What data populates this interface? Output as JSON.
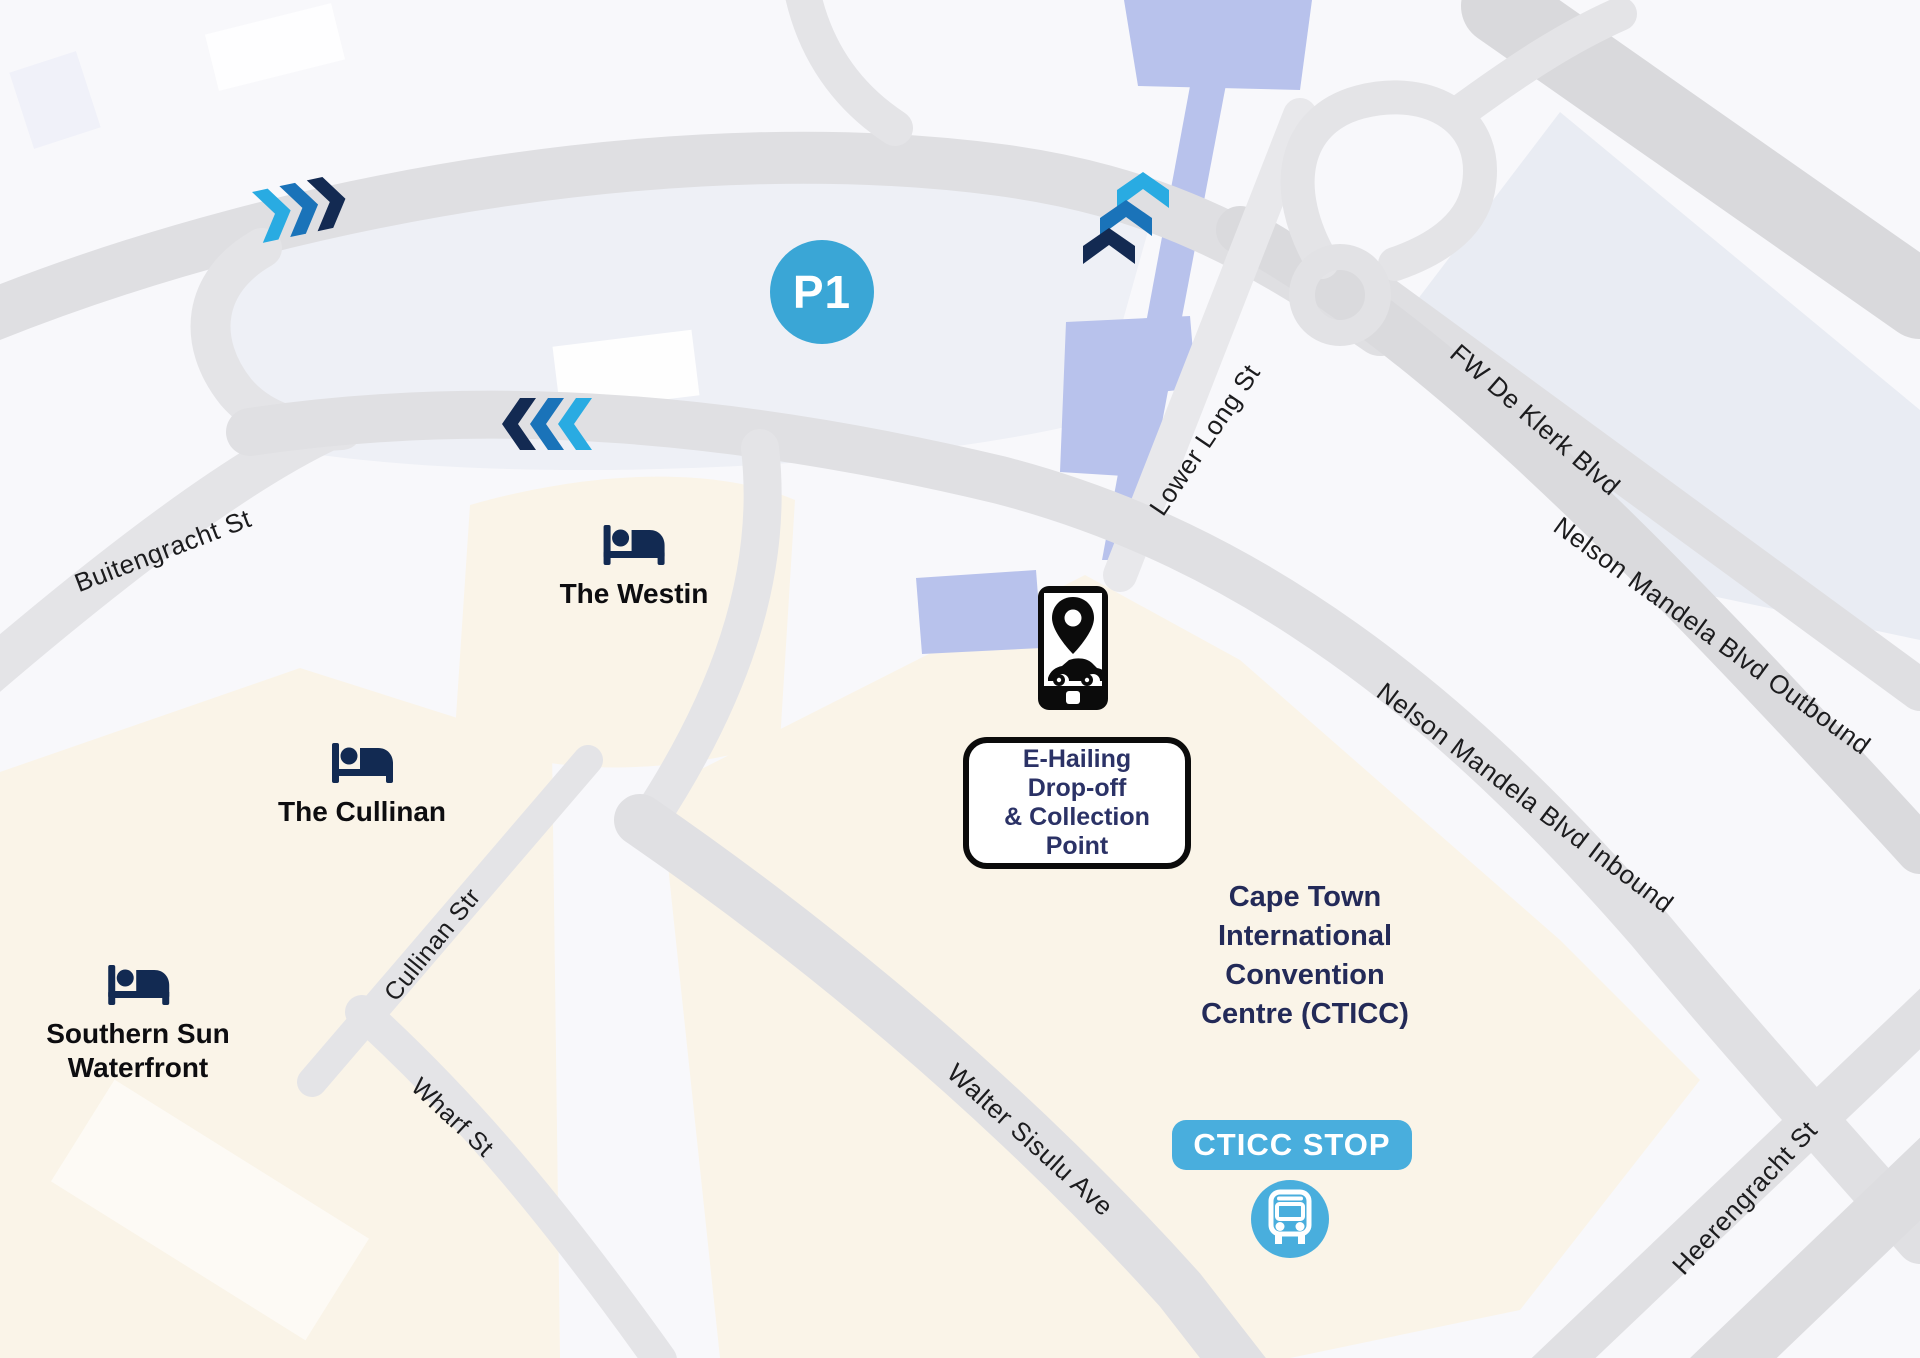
{
  "map": {
    "parking_label": "P1",
    "bus_stop": {
      "label": "CTICC STOP"
    },
    "ehailing": {
      "lines": [
        "E-Hailing",
        "Drop-off",
        "& Collection",
        "Point"
      ]
    },
    "cticc": {
      "lines": [
        "Cape Town",
        "International",
        "Convention",
        "Centre (CTICC)"
      ]
    },
    "hotels": [
      {
        "label": "The Westin"
      },
      {
        "label": "The Cullinan"
      },
      {
        "label": "Southern Sun",
        "label2": "Waterfront"
      }
    ],
    "streets": [
      {
        "name": "Buitengracht St"
      },
      {
        "name": "Lower Long St"
      },
      {
        "name": "FW De Klerk Blvd"
      },
      {
        "name": "Nelson Mandela Blvd Outbound"
      },
      {
        "name": "Nelson Mandela Blvd Inbound"
      },
      {
        "name": "Heerengracht St"
      },
      {
        "name": "Walter Sisulu Ave"
      },
      {
        "name": "Cullinan Str"
      },
      {
        "name": "Wharf St"
      }
    ],
    "colors": {
      "background": "#f8f8fb",
      "road": "#e4e4e7",
      "road_dark": "#dadadd",
      "block_cream": "#faf4e8",
      "block_parking": "#eef0f6",
      "block_building": "#e9ecf3",
      "water_building": "#b8c2ec",
      "chevron_light": "#29abe2",
      "chevron_mid": "#1a73b9",
      "chevron_dark": "#132a52",
      "navy": "#122a52",
      "marker_blue": "#3aa6d6",
      "stop_blue": "#49aedd",
      "text_navy": "#272e62",
      "label_black": "#1c1c1e"
    }
  }
}
